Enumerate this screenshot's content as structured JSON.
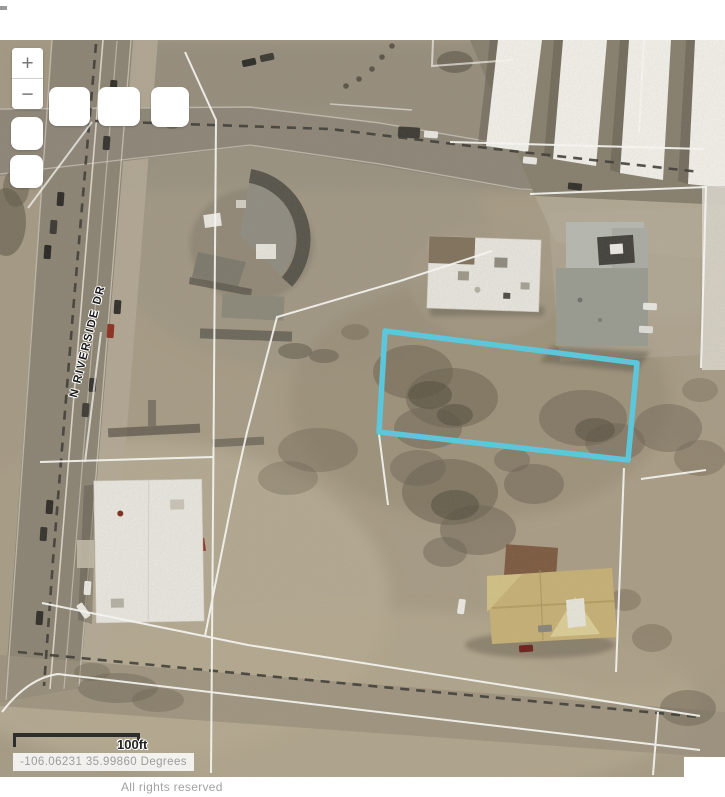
{
  "ui": {
    "zoom_in_label": "+",
    "zoom_out_label": "−",
    "scale_label": "100ft",
    "coordinates": "-106.06231 35.99860 Degrees",
    "attribution": "All rights reserved"
  },
  "map": {
    "road_label": "N RIVERSIDE DR",
    "colors": {
      "parcel_highlight": "#5cc7da",
      "parcel_line": "#fbfbf8",
      "road_dash": "#3b3a34"
    }
  }
}
